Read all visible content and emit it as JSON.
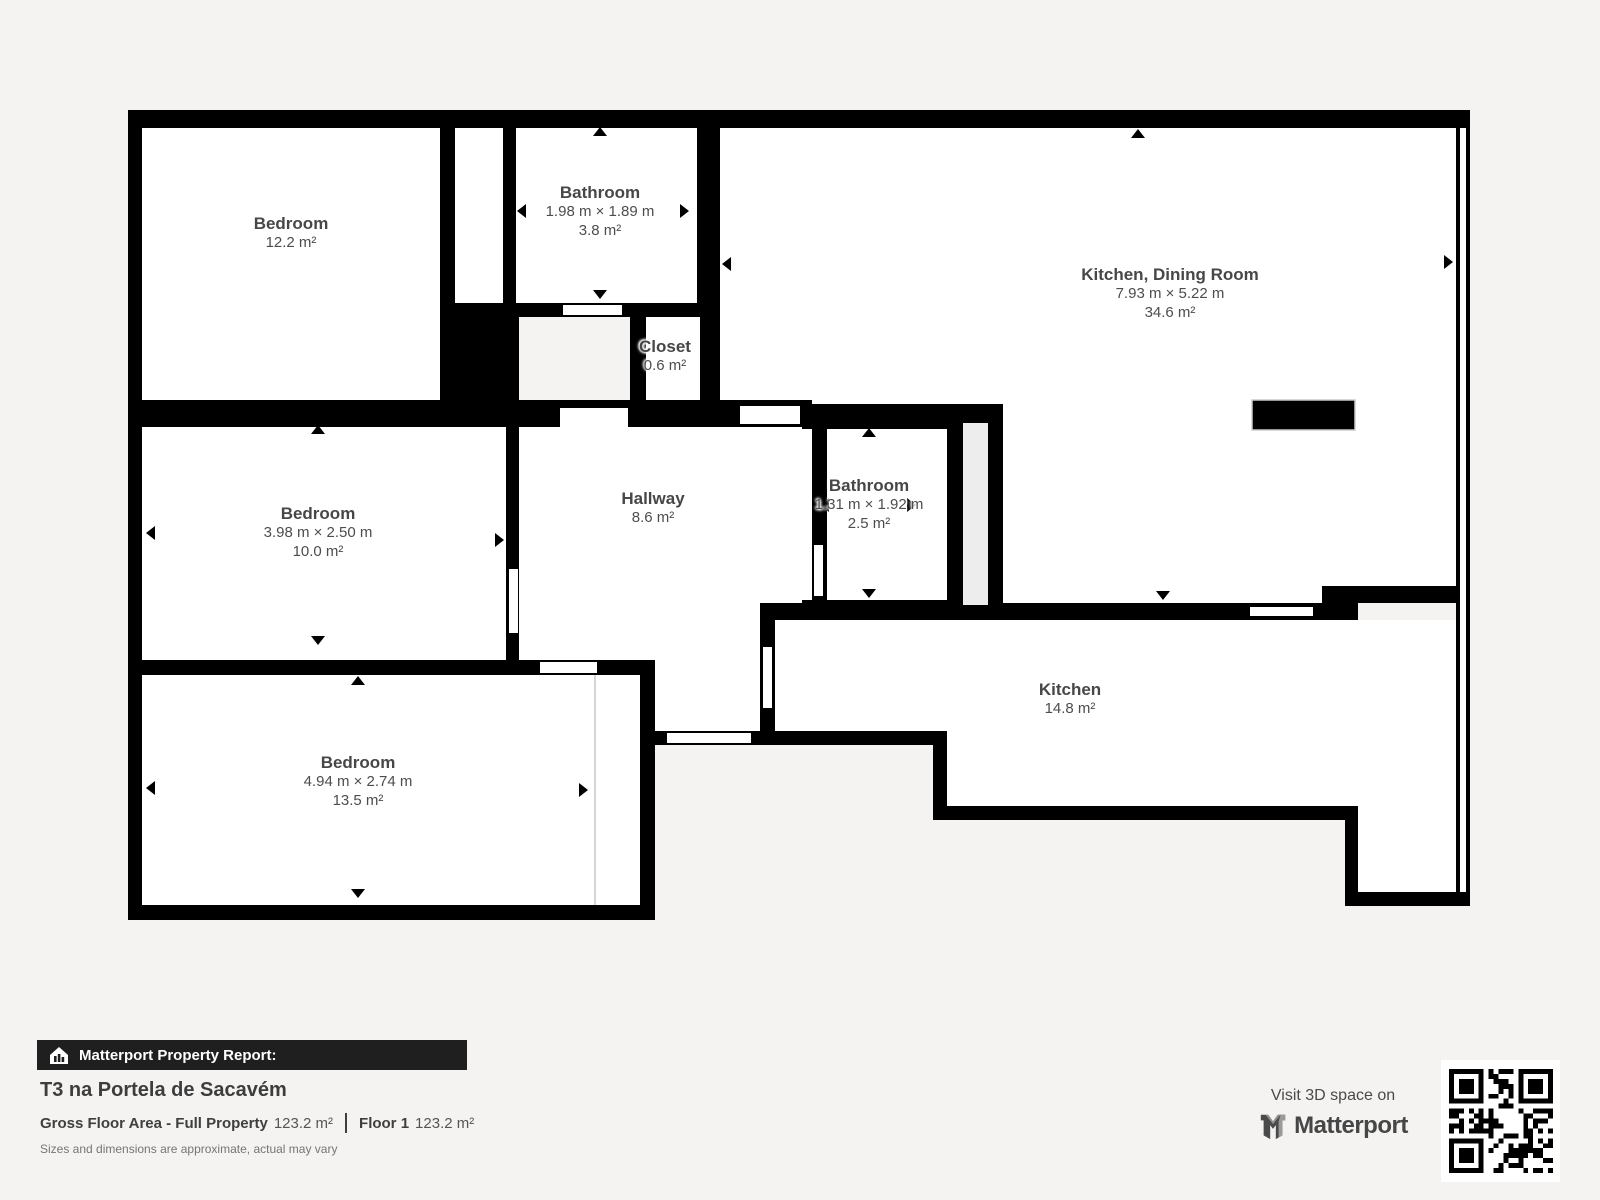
{
  "plan": {
    "rooms": [
      {
        "name": "Bedroom",
        "area": "12.2 m²"
      },
      {
        "name": "Bathroom",
        "dims": "1.98 m × 1.89 m",
        "area": "3.8 m²"
      },
      {
        "name": "Kitchen, Dining Room",
        "dims": "7.93 m × 5.22 m",
        "area": "34.6 m²"
      },
      {
        "name": "Closet",
        "area": "0.6 m²"
      },
      {
        "name": "Bedroom",
        "dims": "3.98 m × 2.50 m",
        "area": "10.0 m²"
      },
      {
        "name": "Hallway",
        "area": "8.6 m²"
      },
      {
        "name": "Bathroom",
        "dims": "1.31 m × 1.92 m",
        "area": "2.5 m²"
      },
      {
        "name": "Kitchen",
        "area": "14.8 m²"
      },
      {
        "name": "Bedroom",
        "dims": "4.94 m × 2.74 m",
        "area": "13.5 m²"
      }
    ],
    "colors": {
      "wall": "#000000",
      "floor": "#ffffff",
      "background": "#f4f3f1",
      "duct": "#ededed"
    }
  },
  "report": {
    "banner": "Matterport Property Report:",
    "property_title": "T3 na Portela de Sacavém",
    "gross_label": "Gross Floor Area - Full Property",
    "gross_value": "123.2 m²",
    "floor_label": "Floor 1",
    "floor_value": "123.2 m²",
    "disclaimer": "Sizes and dimensions are approximate, actual may vary"
  },
  "cta": {
    "visit": "Visit 3D space on",
    "brand": "Matterport"
  },
  "icons": {
    "banner_icon": "house-chart-icon",
    "brand_icon": "matterport-m-icon",
    "qr": "qr-code"
  }
}
